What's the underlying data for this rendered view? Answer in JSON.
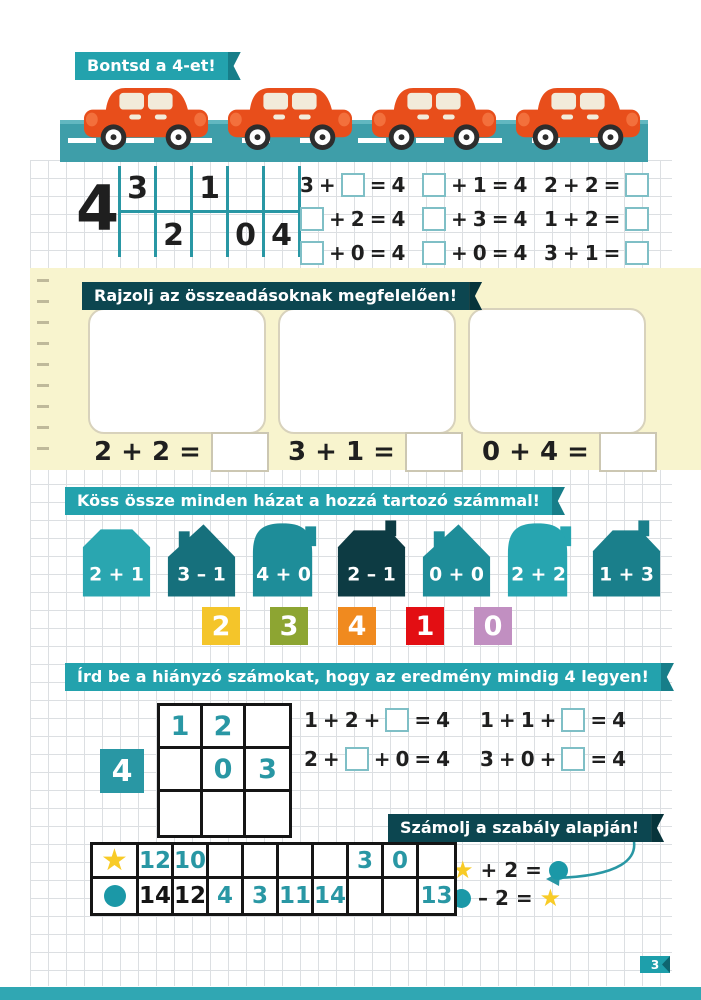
{
  "colors": {
    "ribbon_teal": "#23A2AD",
    "ribbon_dark": "#0C4650",
    "pen_teal": "#2997A4",
    "ink_black": "#1F1F1F",
    "road_teal": "#3E9EA9",
    "car_orange": "#E84E1B",
    "note_yellow": "#F8F4CE",
    "star_gold": "#F8CB26",
    "circle_teal": "#1B98A7"
  },
  "header": {
    "title": "Bontsd a 4-et!"
  },
  "cars": {
    "count": 4
  },
  "decomposition": {
    "total": "4",
    "top": [
      "3",
      "",
      "1",
      "",
      ""
    ],
    "bottom": [
      "",
      "2",
      "",
      "0",
      "4"
    ]
  },
  "addition_exercises": [
    [
      "3",
      "+",
      "□",
      "=",
      "4"
    ],
    [
      "□",
      "+",
      "1",
      "=",
      "4"
    ],
    [
      "2",
      "+",
      "2",
      "=",
      "□"
    ],
    [
      "□",
      "+",
      "2",
      "=",
      "4"
    ],
    [
      "□",
      "+",
      "3",
      "=",
      "4"
    ],
    [
      "1",
      "+",
      "2",
      "=",
      "□"
    ],
    [
      "□",
      "+",
      "0",
      "=",
      "4"
    ],
    [
      "□",
      "+",
      "0",
      "=",
      "4"
    ],
    [
      "3",
      "+",
      "1",
      "=",
      "□"
    ]
  ],
  "draw_section": {
    "title": "Rajzolj az összeadásoknak megfelelően!",
    "problems": [
      "2 + 2 =",
      "3 + 1 =",
      "0 + 4 ="
    ]
  },
  "houses_section": {
    "title": "Köss össze minden házat a hozzá tartozó számmal!",
    "houses": [
      {
        "label": "2 + 1",
        "shape": "block-chamfer",
        "color": "#2AA6B0"
      },
      {
        "label": "3 – 1",
        "shape": "peak-roof",
        "color": "#16707C"
      },
      {
        "label": "4 + 0",
        "shape": "dome",
        "color": "#1E8D99"
      },
      {
        "label": "2 – 1",
        "shape": "block-chimney",
        "color": "#0D3B43"
      },
      {
        "label": "0 + 0",
        "shape": "peak-roof",
        "color": "#1E8D99"
      },
      {
        "label": "2 + 2",
        "shape": "dome",
        "color": "#27A5B0"
      },
      {
        "label": "1 + 3",
        "shape": "trapezoid",
        "color": "#1A7F8B"
      }
    ],
    "numbers": [
      {
        "value": "2",
        "color": "#F4C52A"
      },
      {
        "value": "3",
        "color": "#8DA532"
      },
      {
        "value": "4",
        "color": "#F08A1F"
      },
      {
        "value": "1",
        "color": "#E30E13"
      },
      {
        "value": "0",
        "color": "#C18FC1"
      }
    ]
  },
  "missing_section": {
    "title": "Írd be a hiányzó számokat, hogy az eredmény mindig 4 legyen!",
    "total": "4",
    "grid": [
      [
        "1",
        "2",
        ""
      ],
      [
        "",
        "0",
        "3"
      ],
      [
        "",
        "",
        ""
      ]
    ],
    "equations": [
      [
        "1",
        "+",
        "2",
        "+",
        "□",
        "=",
        "4"
      ],
      [
        "1",
        "+",
        "1",
        "+",
        "□",
        "=",
        "4"
      ],
      [
        "2",
        "+",
        "□",
        "+",
        "0",
        "=",
        "4"
      ],
      [
        "3",
        "+",
        "0",
        "+",
        "□",
        "=",
        "4"
      ]
    ]
  },
  "rule_section": {
    "title": "Számolj a szabály alapján!",
    "rules": [
      {
        "lhs": "star",
        "op": "+ 2 =",
        "rhs": "circle"
      },
      {
        "lhs": "circle",
        "op": "– 2 =",
        "rhs": "star"
      }
    ],
    "table": {
      "star_row": [
        {
          "v": "12",
          "ink": "pen"
        },
        {
          "v": "10",
          "ink": "pen"
        },
        {
          "v": "",
          "ink": "pen"
        },
        {
          "v": "",
          "ink": "pen"
        },
        {
          "v": "",
          "ink": "pen"
        },
        {
          "v": "",
          "ink": "pen"
        },
        {
          "v": "3",
          "ink": "pen"
        },
        {
          "v": "0",
          "ink": "pen"
        },
        {
          "v": "",
          "ink": "pen"
        }
      ],
      "circle_row": [
        {
          "v": "14",
          "ink": "print"
        },
        {
          "v": "12",
          "ink": "print"
        },
        {
          "v": "4",
          "ink": "pen"
        },
        {
          "v": "3",
          "ink": "pen"
        },
        {
          "v": "11",
          "ink": "pen"
        },
        {
          "v": "14",
          "ink": "pen"
        },
        {
          "v": "",
          "ink": "pen"
        },
        {
          "v": "",
          "ink": "pen"
        },
        {
          "v": "13",
          "ink": "pen"
        }
      ]
    }
  },
  "page_number": "3"
}
